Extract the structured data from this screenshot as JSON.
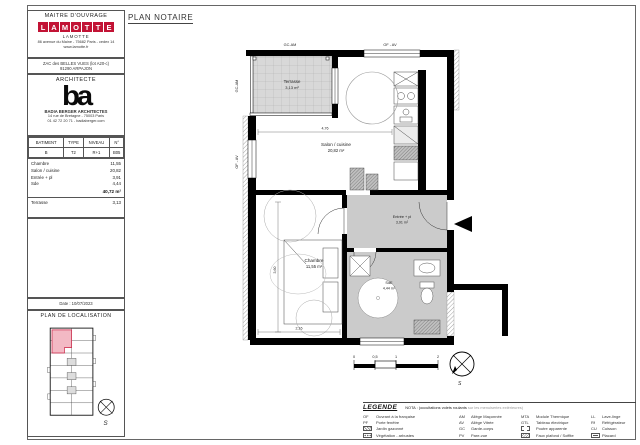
{
  "sheet": {
    "title": "PLAN NOTAIRE"
  },
  "colors": {
    "accent_red": "#c21335",
    "room_gray": "#cbcbcb",
    "terrace_gray": "#d8d8d8",
    "highlight_pink": "#f3b9c4",
    "wall_black": "#000000"
  },
  "cartouche": {
    "maitre_ouvrage": {
      "header": "MAITRE D'OUVRAGE",
      "logo_letters": [
        "L",
        "A",
        "M",
        "O",
        "T",
        "T",
        "E"
      ],
      "company": "LAMOTTE",
      "address": "86 avenue du Maine - 75682 Paris - cedex 14",
      "website": "www.lamotte.fr"
    },
    "operation": {
      "line1": "ZAC des BELLES VUES (lot A20-c)",
      "line2": "91290 ARPAJON"
    },
    "architecte": {
      "header": "ARCHITECTE",
      "logo": "ba",
      "name": "BADIA BERGER ARCHITECTES",
      "address": "14 rue de Bretagne - 75003 Paris",
      "contact": "01 42 72 20 71 - badiaberger.com"
    },
    "unit_table": {
      "headers": [
        "BATIMENT",
        "TYPE",
        "NIVEAU",
        "N°"
      ],
      "values": [
        "B",
        "T2",
        "R+1",
        "B05"
      ]
    },
    "areas": {
      "rows": [
        {
          "label": "Chambre",
          "value": "11,55"
        },
        {
          "label": "Salon / cuisine",
          "value": "20,82"
        },
        {
          "label": "Entrée + pl",
          "value": "3,91"
        },
        {
          "label": "Sde",
          "value": "4,44"
        }
      ],
      "total": "40,72 m²",
      "terrasse": {
        "label": "Terrasse",
        "value": "3,13"
      }
    },
    "date": "Date : 10/07/2023",
    "localisation": {
      "header": "PLAN DE LOCALISATION",
      "compass_letter": "S"
    }
  },
  "plan": {
    "labels": {
      "terrasse": "Terrasse",
      "terrasse_area": "3,13 m²",
      "salon": "Salon / cuisine",
      "salon_area": "20,82 m²",
      "chambre": "Chambre",
      "chambre_area": "11,55 m²",
      "entree": "Entrée + pl",
      "entree_area": "3,91 m²",
      "sde": "SdE",
      "sde_area": "4,44 m²"
    },
    "window_tags": {
      "top_left": "GC-AM",
      "top_right": "OF - AV",
      "left_top": "GC-AM",
      "left_mid": "OF - AV"
    },
    "dimensions": {
      "salon_width": "4,76",
      "chambre_height": "3,60",
      "chambre_width": "2,16"
    },
    "scale_ticks": [
      "0",
      "0,5",
      "1",
      "2"
    ],
    "compass_letter": "S"
  },
  "legend": {
    "title": "LEGENDE",
    "nota_black": "NOTA : (occultations volets roulants",
    "nota_gray": " sur les menuiseries extérieures)",
    "columns": [
      {
        "items": [
          {
            "code": "OF",
            "label": "Ouvrant à la française"
          },
          {
            "code": "PF",
            "label": "Porte fenêtre"
          },
          {
            "icon": "jardin",
            "label": "Jardin gazonné"
          },
          {
            "icon": "vegetation",
            "label": "Végétation - arbustes"
          }
        ]
      },
      {
        "items": [
          {
            "code": "AM",
            "label": "Allège Maçonnée"
          },
          {
            "code": "AV",
            "label": "Allège Vitrée"
          },
          {
            "code": "GC",
            "label": "Garde-corps"
          },
          {
            "code": "PV",
            "label": "Pare-vue"
          }
        ]
      },
      {
        "items": [
          {
            "code": "MTA",
            "label": "Module Thermique"
          },
          {
            "code": "GTL",
            "label": "Tableau électrique"
          },
          {
            "icon": "poutre",
            "label": "Poutre apparente"
          },
          {
            "icon": "soffite",
            "label": "Faux plafond / Soffite"
          }
        ]
      },
      {
        "items": [
          {
            "code": "LL",
            "label": "Lave-linge"
          },
          {
            "code": "Rf",
            "label": "Réfrigérateur"
          },
          {
            "code": "CU",
            "label": "Cuisson"
          },
          {
            "icon": "placard",
            "label": "Placard"
          }
        ]
      }
    ]
  }
}
